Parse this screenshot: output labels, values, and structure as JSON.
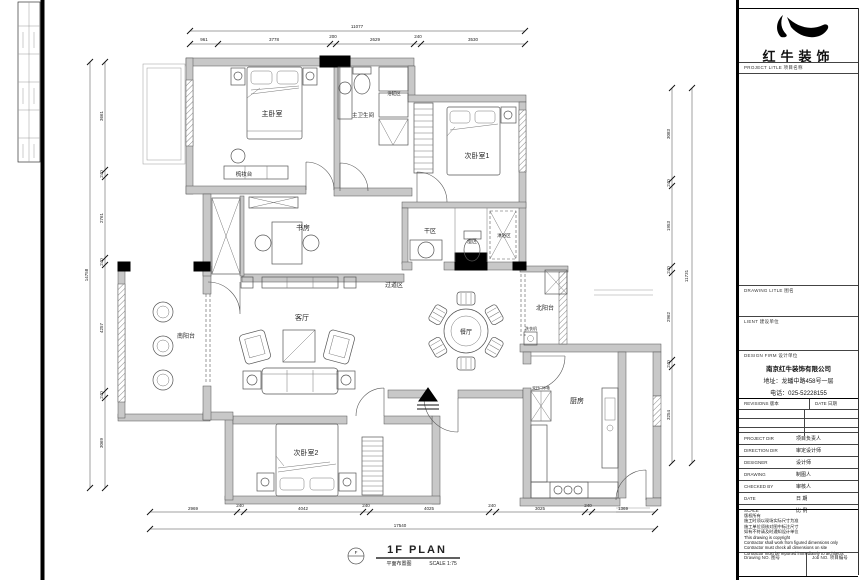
{
  "title_block": {
    "logo_text": "红牛装饰",
    "project_title_label": "PROJECT LITLE  项目名称",
    "drawing_title_label": "DRAWING LITLE  图名",
    "client_label": "LIENT  建设单位",
    "design_firm_label": "DESIGN FIRM  设计单位",
    "company_name": "南京红牛装饰有限公司",
    "company_address": "地址：龙蟠中路458号一层",
    "company_phone": "电话：025-52228155",
    "revisions_label": "REVISIONS  版本",
    "date_col_label": "DATE 日期",
    "fields": [
      {
        "en": "PROJECT DIR",
        "cn": "项目负责人"
      },
      {
        "en": "DIRECTION DIR",
        "cn": "审定设计师"
      },
      {
        "en": "DESIGNER",
        "cn": "设计师"
      },
      {
        "en": "DRAWING",
        "cn": "制图人"
      },
      {
        "en": "CHECKED BY",
        "cn": "审核人"
      },
      {
        "en": "DATE",
        "cn": "日  期"
      },
      {
        "en": "SCALE",
        "cn": "比  例"
      }
    ],
    "notes": [
      "版权所有",
      "施工时须以现场实际尺寸为准",
      "施工单位须核对图中标注尺寸",
      "如有不符请及时通知设计单位",
      "This drawing is copyright",
      "Contractor shall work from figured dimensions only",
      "Contractor must check all dimensions on site",
      "Contractor must be reported immediately to architects"
    ],
    "drawing_no_label": "Drawing NO. 图号",
    "job_no_label": "Job NO. 项目编号"
  },
  "plan": {
    "rooms": [
      {
        "label": "主卧室",
        "x": 272,
        "y": 116,
        "size": 7
      },
      {
        "label": "主卫生间",
        "x": 363,
        "y": 117,
        "size": 5.5
      },
      {
        "label": "浴缸区",
        "x": 394,
        "y": 95,
        "size": 4.5
      },
      {
        "label": "梳妆台",
        "x": 244,
        "y": 176,
        "size": 5.5
      },
      {
        "label": "次卧室1",
        "x": 477,
        "y": 158,
        "size": 7
      },
      {
        "label": "书房",
        "x": 303,
        "y": 230,
        "size": 7
      },
      {
        "label": "干区",
        "x": 430,
        "y": 233,
        "size": 6
      },
      {
        "label": "湿区",
        "x": 472,
        "y": 243,
        "size": 5
      },
      {
        "label": "淋浴区",
        "x": 504,
        "y": 237,
        "size": 4.5
      },
      {
        "label": "过道区",
        "x": 394,
        "y": 287,
        "size": 6
      },
      {
        "label": "客厅",
        "x": 302,
        "y": 320,
        "size": 7
      },
      {
        "label": "餐厅",
        "x": 466,
        "y": 334,
        "size": 6
      },
      {
        "label": "北阳台",
        "x": 545,
        "y": 310,
        "size": 6
      },
      {
        "label": "南阳台",
        "x": 186,
        "y": 338,
        "size": 6
      },
      {
        "label": "厨房",
        "x": 577,
        "y": 403,
        "size": 7
      },
      {
        "label": "次卧室2",
        "x": 306,
        "y": 455,
        "size": 7
      },
      {
        "label": "洗衣机",
        "x": 531,
        "y": 330,
        "size": 4
      },
      {
        "label": "双开门冰箱",
        "x": 541,
        "y": 389,
        "size": 3.5
      },
      {
        "label": "1F PLAN",
        "x": 417,
        "y": 553,
        "size": 11,
        "cls": "plan-title"
      },
      {
        "label": "平面布置图",
        "x": 399,
        "y": 565,
        "size": 5
      },
      {
        "label": "SCALE 1:75",
        "x": 443,
        "y": 565,
        "size": 5
      },
      {
        "label": "F",
        "x": 356,
        "y": 554,
        "size": 4.5
      }
    ],
    "dimensions": {
      "top": {
        "axis": 44,
        "total_axis": 31,
        "rotate": 0,
        "ticks": [
          190,
          218,
          330,
          336,
          414,
          421,
          525
        ],
        "segments": [
          {
            "text": "961",
            "x": 204,
            "y": 41
          },
          {
            "text": "3778",
            "x": 274,
            "y": 41
          },
          {
            "text": "200",
            "x": 333,
            "y": 38
          },
          {
            "text": "2629",
            "x": 375,
            "y": 41
          },
          {
            "text": "240",
            "x": 418,
            "y": 38
          },
          {
            "text": "3530",
            "x": 473,
            "y": 41
          }
        ],
        "total": {
          "text": "11077",
          "x": 357,
          "y": 28
        }
      },
      "bottom": {
        "axis": 512,
        "total_axis": 529,
        "rotate": 0,
        "ticks": [
          150,
          237,
          244,
          363,
          370,
          489,
          496,
          585,
          592,
          655
        ],
        "segments": [
          {
            "text": "2969",
            "x": 193,
            "y": 510
          },
          {
            "text": "240",
            "x": 240,
            "y": 507
          },
          {
            "text": "4042",
            "x": 303,
            "y": 510
          },
          {
            "text": "240",
            "x": 366,
            "y": 507
          },
          {
            "text": "4025",
            "x": 429,
            "y": 510
          },
          {
            "text": "240",
            "x": 492,
            "y": 507
          },
          {
            "text": "3025",
            "x": 540,
            "y": 510
          },
          {
            "text": "240",
            "x": 588,
            "y": 507
          },
          {
            "text": "1369",
            "x": 623,
            "y": 510
          }
        ],
        "total": {
          "text": "17540",
          "x": 400,
          "y": 527
        }
      },
      "left": {
        "axis": 105,
        "total_axis": 90,
        "rotate": -90,
        "ticks": [
          62,
          170,
          177,
          258,
          265,
          391,
          398,
          488
        ],
        "segments": [
          {
            "text": "3661",
            "x": 103,
            "y": 116
          },
          {
            "text": "240",
            "x": 103,
            "y": 174
          },
          {
            "text": "2761",
            "x": 103,
            "y": 218
          },
          {
            "text": "240",
            "x": 103,
            "y": 262
          },
          {
            "text": "4257",
            "x": 103,
            "y": 328
          },
          {
            "text": "240",
            "x": 103,
            "y": 395
          },
          {
            "text": "3069",
            "x": 103,
            "y": 443
          }
        ],
        "total": {
          "text": "14758",
          "x": 88,
          "y": 275
        }
      },
      "right": {
        "axis": 672,
        "total_axis": 692,
        "rotate": -90,
        "ticks": [
          88,
          179,
          186,
          266,
          273,
          360,
          367,
          463
        ],
        "segments": [
          {
            "text": "3083",
            "x": 670,
            "y": 134
          },
          {
            "text": "240",
            "x": 670,
            "y": 183
          },
          {
            "text": "1953",
            "x": 670,
            "y": 226
          },
          {
            "text": "240",
            "x": 670,
            "y": 270
          },
          {
            "text": "2962",
            "x": 670,
            "y": 317
          },
          {
            "text": "240",
            "x": 670,
            "y": 364
          },
          {
            "text": "3254",
            "x": 670,
            "y": 415
          }
        ],
        "total": {
          "text": "11731",
          "x": 688,
          "y": 276
        }
      }
    }
  }
}
